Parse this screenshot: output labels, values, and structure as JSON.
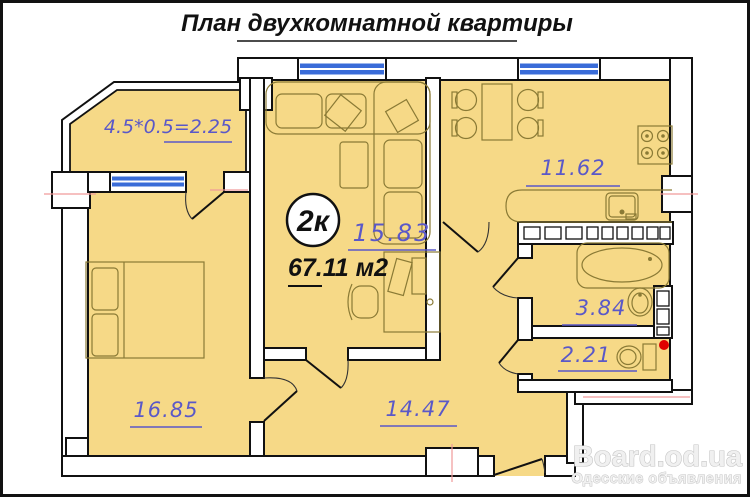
{
  "title": "План двухкомнатной квартиры",
  "badge": "2к",
  "total_area": "67.11 м2",
  "rooms": {
    "balcony": "4.5*0.5=2.25",
    "living": "15.83",
    "kitchen": "11.62",
    "bathroom": "3.84",
    "toilet": "2.21",
    "bedroom": "16.85",
    "hallway": "14.47"
  },
  "watermark": {
    "site": "Board.od.ua",
    "tagline": "Одесские объявления"
  },
  "colors": {
    "room_fill": "#f6d987",
    "window_blue": "#3a6cd8",
    "area_label": "#5a58c8",
    "marker_red": "#e00000",
    "axis_red": "#f09a9a"
  }
}
